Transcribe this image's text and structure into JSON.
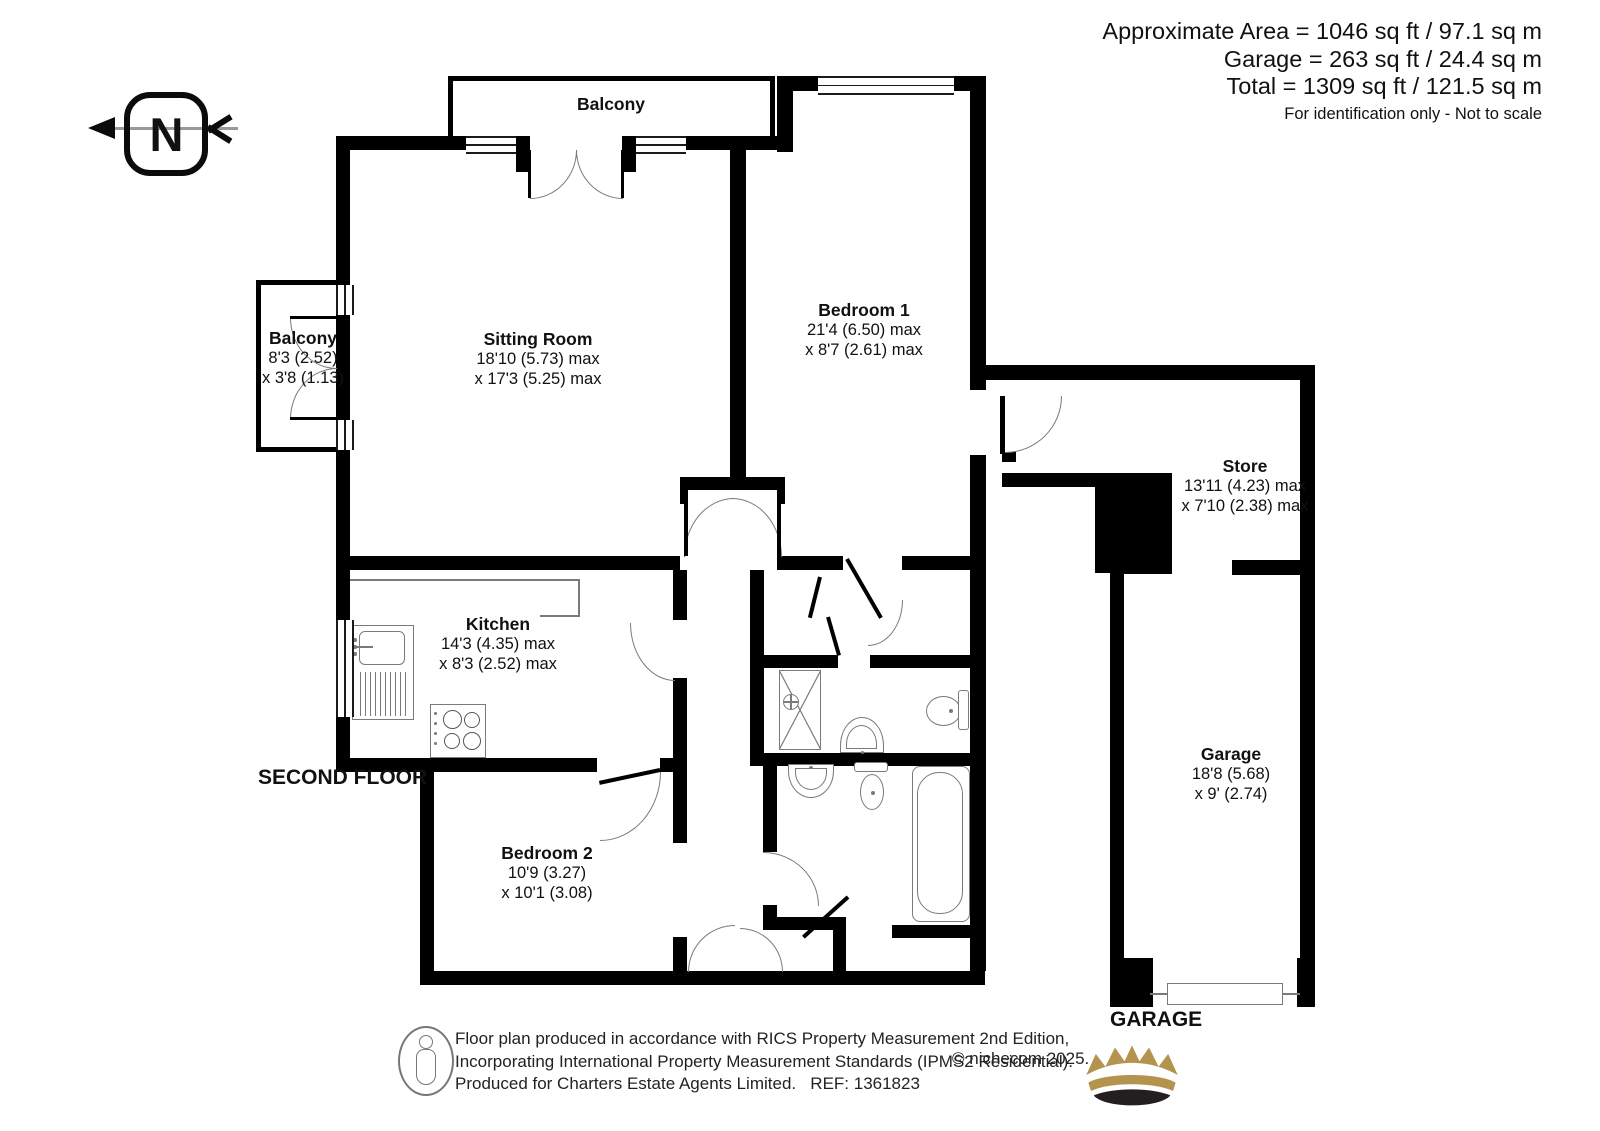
{
  "header": {
    "area_line1": "Approximate Area = 1046 sq ft / 97.1 sq m",
    "area_line2": "Garage = 263 sq ft / 24.4 sq m",
    "area_line3": "Total = 1309 sq ft / 121.5 sq m",
    "disclaimer": "For identification only - Not to scale"
  },
  "compass": {
    "label": "N"
  },
  "rooms": {
    "balcony_top": {
      "name": "Balcony"
    },
    "sitting_room": {
      "name": "Sitting Room",
      "dim1": "18'10 (5.73) max",
      "dim2": "x 17'3 (5.25) max"
    },
    "bedroom1": {
      "name": "Bedroom 1",
      "dim1": "21'4 (6.50) max",
      "dim2": "x 8'7 (2.61) max"
    },
    "balcony_left": {
      "name": "Balcony",
      "dim1": "8'3 (2.52)",
      "dim2": "x 3'8 (1.13)"
    },
    "store": {
      "name": "Store",
      "dim1": "13'11 (4.23) max",
      "dim2": "x 7'10 (2.38) max"
    },
    "kitchen": {
      "name": "Kitchen",
      "dim1": "14'3 (4.35) max",
      "dim2": "x 8'3 (2.52) max"
    },
    "bedroom2": {
      "name": "Bedroom 2",
      "dim1": "10'9 (3.27)",
      "dim2": "x 10'1 (3.08)"
    },
    "garage": {
      "name": "Garage",
      "dim1": "18'8 (5.68)",
      "dim2": "x 9' (2.74)"
    }
  },
  "labels": {
    "floor": "SECOND FLOOR",
    "garage_caption": "GARAGE"
  },
  "footer": {
    "line1": "Floor plan produced in accordance with RICS Property Measurement 2nd Edition,",
    "line2": "Incorporating International Property Measurement Standards (IPMS2 Residential).",
    "copyright": "© nichecom 2025.",
    "line3": "Produced for Charters Estate Agents Limited.   REF: 1361823"
  },
  "colors": {
    "wall": "#000000",
    "fixture_line": "#7a7a7a",
    "crown_gold": "#b3934d",
    "crown_dark": "#231f20"
  }
}
